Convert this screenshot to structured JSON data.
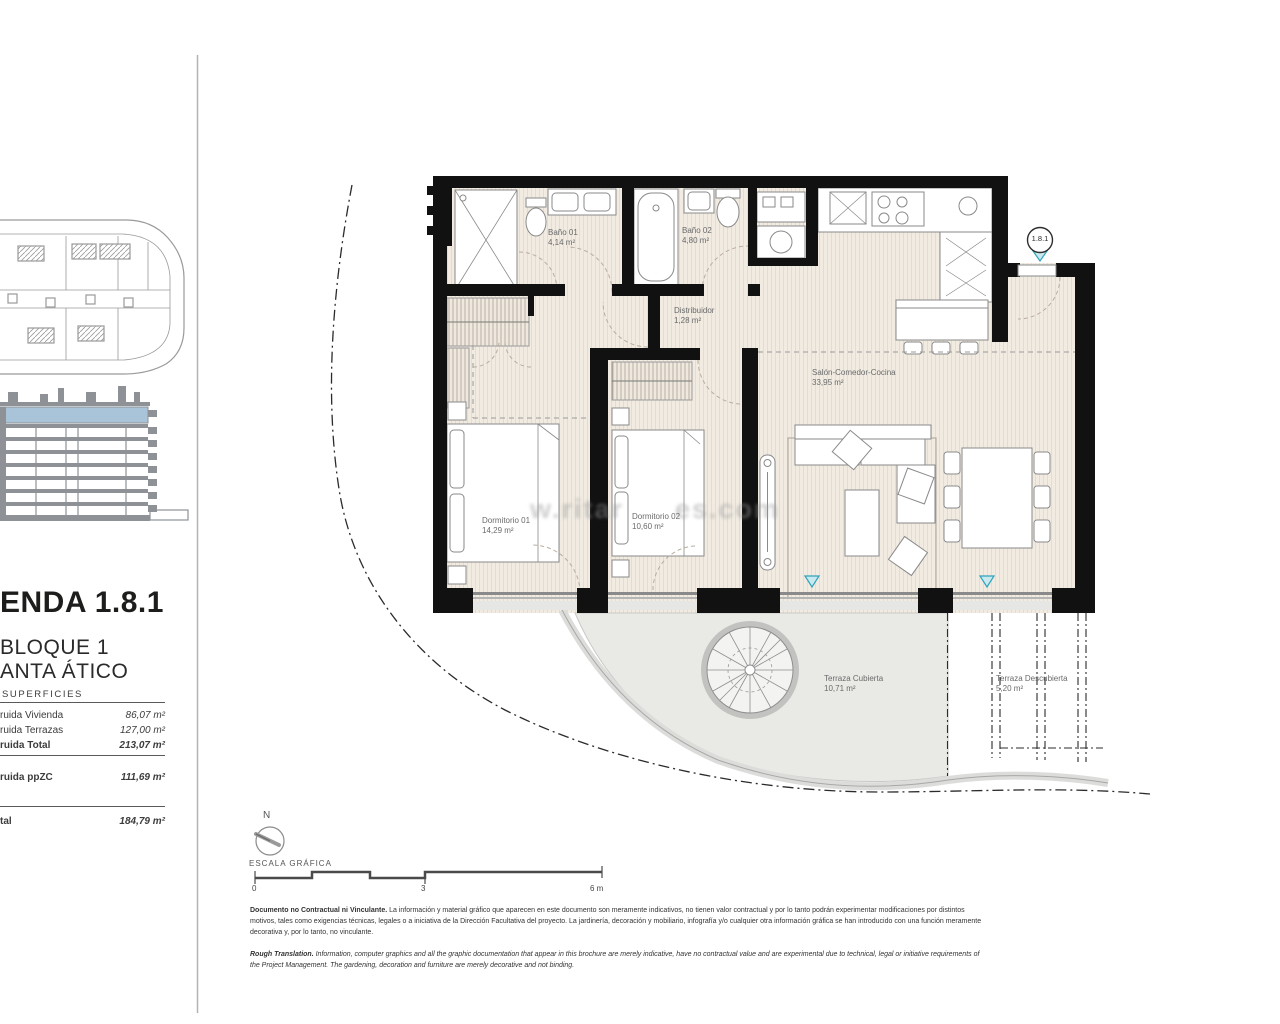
{
  "panel": {
    "title": "ENDA 1.8.1",
    "block": "BLOQUE 1",
    "floor": "ANTA ÁTICO",
    "surfaces_heading": "SUPERFICIES",
    "rows": {
      "vivienda": {
        "label": "ruida Vivienda",
        "value": "86,07 m²"
      },
      "terrazas": {
        "label": "ruida Terrazas",
        "value": "127,00 m²"
      },
      "total": {
        "label": "ruida Total",
        "value": "213,07 m²"
      },
      "ppzc": {
        "label": "ruida ppZC",
        "value": "111,69 m²"
      },
      "util": {
        "label": "tal",
        "value": "184,79 m²"
      }
    }
  },
  "plan": {
    "unit_marker": "1.8.1",
    "watermark": {
      "left": "w.ritar",
      "right": "es.com"
    },
    "rooms": {
      "banio01": {
        "name": "Baño 01",
        "area": "4,14 m²"
      },
      "banio02": {
        "name": "Baño 02",
        "area": "4,80 m²"
      },
      "distribuidor": {
        "name": "Distribuidor",
        "area": "1,28 m²"
      },
      "salon": {
        "name": "Salón-Comedor-Cocina",
        "area": "33,95 m²"
      },
      "dormitorio01": {
        "name": "Dormitorio 01",
        "area": "14,29 m²"
      },
      "dormitorio02": {
        "name": "Dormitorio 02",
        "area": "10,60 m²"
      },
      "terraza_cubierta": {
        "name": "Terraza Cubierta",
        "area": "10,71 m²"
      },
      "terraza_descubierta": {
        "name": "Terraza Descubierta",
        "area": "5,20 m²"
      }
    },
    "colors": {
      "wall": "#111111",
      "floor": "#f1ebe2",
      "terrace": "#e9e9e6",
      "accent_teal": "#2fa3ba",
      "elevation_highlight": "#a9c4d9"
    }
  },
  "scale": {
    "north": "N",
    "label": "ESCALA GRÁFICA",
    "ticks": [
      "0",
      "3",
      "6 m"
    ]
  },
  "disclaimer": {
    "es_lead": "Documento no Contractual ni Vinculante.",
    "es_body": " La información y material gráfico que aparecen en este documento son meramente indicativos, no tienen valor contractual y por lo tanto podrán experimentar modificaciones por distintos motivos, tales como exigencias técnicas, legales o a iniciativa de la Dirección Facultativa del proyecto. La jardinería, decoración y mobiliario, infografía y/o cualquier otra información gráfica se han introducido con una función meramente decorativa y, por lo tanto, no vinculante.",
    "en_lead": "Rough Translation.",
    "en_body": " Information, computer graphics and all the graphic documentation that appear in this brochure are merely indicative, have no contractual value and are experimental due to technical, legal or initiative requirements of the Project Management. The gardening, decoration and furniture are merely decorative and not binding."
  }
}
